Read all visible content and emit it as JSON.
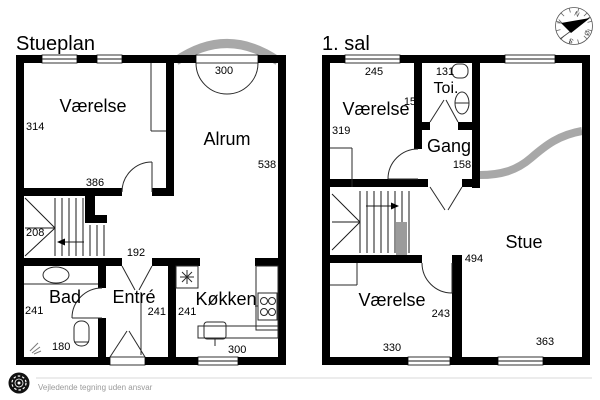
{
  "colors": {
    "wall": "#000000",
    "accent_gray": "#a8a8a8",
    "stair_gray": "#9b9b9b",
    "footer_text": "#9a9a9a"
  },
  "stueplan": {
    "title": "Stueplan",
    "vaerelse": {
      "name": "Værelse",
      "width": "314",
      "bottom": "386"
    },
    "alrum": {
      "name": "Alrum",
      "height": "538",
      "entrance": "300"
    },
    "stairs": {
      "width": "208"
    },
    "bad": {
      "name": "Bad",
      "width": "241",
      "shower": "180"
    },
    "entre": {
      "name": "Entré",
      "width": "241",
      "door": "192"
    },
    "koekken": {
      "name": "Køkken",
      "width": "241",
      "window": "300"
    }
  },
  "sal1": {
    "title": "1. sal",
    "vaerelse_top": {
      "name": "Værelse",
      "top": "245",
      "left": "319"
    },
    "toi": {
      "name": "Toi.",
      "top": "131",
      "left": "150"
    },
    "gang": {
      "name": "Gang",
      "width": "158"
    },
    "stue": {
      "name": "Stue",
      "left": "494",
      "window": "363"
    },
    "vaerelse_bottom": {
      "name": "Værelse",
      "right": "243",
      "window": "330"
    }
  },
  "compass": {
    "n": "N",
    "east": "Ø",
    "s": "S",
    "w": "V"
  },
  "footer": {
    "disclaimer": "Vejledende tegning uden ansvar"
  }
}
